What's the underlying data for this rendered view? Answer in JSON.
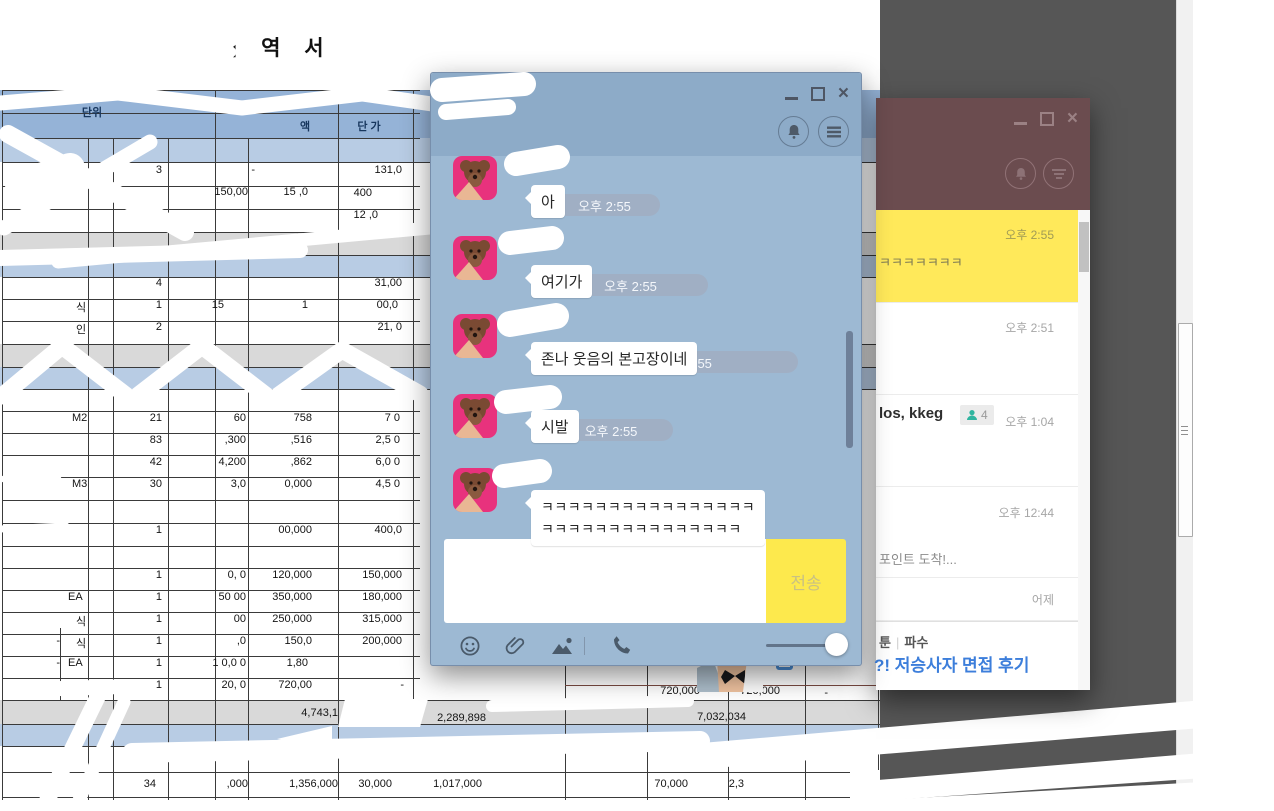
{
  "colors": {
    "chat_header": "#8dabc8",
    "chat_body": "#9db9d3",
    "time_pill": "#a0afc4",
    "send_button_yellow": "#fde94d",
    "friends_header_maroon": "#6b4c4f",
    "selected_chat_yellow": "#ffe95a",
    "ad_link_blue": "#3c7edb",
    "excel_header_blue": "#95b3d7",
    "excel_light_blue_row": "#b8cce4",
    "excel_gray_row": "#d9d9d9",
    "desktop_dark_panel": "#565656",
    "avatar_pink": "#e8327d"
  },
  "spreadsheet": {
    "title": "내 역 서",
    "cells": [
      {
        "x": 70,
        "y": 104,
        "w": 44,
        "t": "단위",
        "a": "c",
        "h": 1
      },
      {
        "x": 382,
        "y": 93,
        "w": 50,
        "t": "노 무",
        "a": "c",
        "h": 1
      },
      {
        "x": 292,
        "y": 118,
        "w": 26,
        "t": "액",
        "a": "c",
        "h": 1
      },
      {
        "x": 344,
        "y": 118,
        "w": 50,
        "t": "단 가",
        "a": "c",
        "h": 1
      },
      {
        "x": 118,
        "y": 164,
        "w": 44,
        "t": "3"
      },
      {
        "x": 225,
        "y": 164,
        "w": 30,
        "t": "-"
      },
      {
        "x": 348,
        "y": 164,
        "w": 54,
        "t": "131,0"
      },
      {
        "x": 192,
        "y": 186,
        "w": 56,
        "t": "150,00"
      },
      {
        "x": 258,
        "y": 186,
        "w": 50,
        "t": "15 ,0"
      },
      {
        "x": 330,
        "y": 187,
        "w": 42,
        "t": "400"
      },
      {
        "x": 328,
        "y": 209,
        "w": 50,
        "t": "12 ,0"
      },
      {
        "x": 276,
        "y": 232,
        "w": 52,
        "t": "150,00"
      },
      {
        "x": 118,
        "y": 277,
        "w": 44,
        "t": "4"
      },
      {
        "x": 352,
        "y": 277,
        "w": 50,
        "t": "31,00"
      },
      {
        "x": 76,
        "y": 299,
        "w": 18,
        "t": "식",
        "a": "l"
      },
      {
        "x": 118,
        "y": 299,
        "w": 44,
        "t": "1"
      },
      {
        "x": 178,
        "y": 299,
        "w": 46,
        "t": "15"
      },
      {
        "x": 270,
        "y": 299,
        "w": 38,
        "t": "1"
      },
      {
        "x": 348,
        "y": 299,
        "w": 50,
        "t": "00,0"
      },
      {
        "x": 76,
        "y": 321,
        "w": 18,
        "t": "인",
        "a": "l"
      },
      {
        "x": 118,
        "y": 321,
        "w": 44,
        "t": "2"
      },
      {
        "x": 350,
        "y": 321,
        "w": 52,
        "t": "21, 0"
      },
      {
        "x": 72,
        "y": 412,
        "w": 26,
        "t": "M2",
        "a": "l"
      },
      {
        "x": 118,
        "y": 412,
        "w": 44,
        "t": "21"
      },
      {
        "x": 192,
        "y": 412,
        "w": 54,
        "t": "60"
      },
      {
        "x": 258,
        "y": 412,
        "w": 54,
        "t": "758"
      },
      {
        "x": 348,
        "y": 412,
        "w": 52,
        "t": "7 0"
      },
      {
        "x": 118,
        "y": 434,
        "w": 44,
        "t": "83"
      },
      {
        "x": 192,
        "y": 434,
        "w": 54,
        "t": ",300"
      },
      {
        "x": 258,
        "y": 434,
        "w": 54,
        "t": ",516"
      },
      {
        "x": 348,
        "y": 434,
        "w": 52,
        "t": "2,5 0"
      },
      {
        "x": 118,
        "y": 456,
        "w": 44,
        "t": "42"
      },
      {
        "x": 192,
        "y": 456,
        "w": 54,
        "t": "4,200"
      },
      {
        "x": 258,
        "y": 456,
        "w": 54,
        "t": ",862"
      },
      {
        "x": 348,
        "y": 456,
        "w": 52,
        "t": "6,0 0"
      },
      {
        "x": 72,
        "y": 478,
        "w": 26,
        "t": "M3",
        "a": "l"
      },
      {
        "x": 118,
        "y": 478,
        "w": 44,
        "t": "30"
      },
      {
        "x": 192,
        "y": 478,
        "w": 54,
        "t": "3,0"
      },
      {
        "x": 258,
        "y": 478,
        "w": 54,
        "t": "0,000"
      },
      {
        "x": 348,
        "y": 478,
        "w": 52,
        "t": "4,5 0"
      },
      {
        "x": 118,
        "y": 524,
        "w": 44,
        "t": "1"
      },
      {
        "x": 256,
        "y": 524,
        "w": 56,
        "t": "00,000"
      },
      {
        "x": 346,
        "y": 524,
        "w": 56,
        "t": "400,0"
      },
      {
        "x": 118,
        "y": 569,
        "w": 44,
        "t": "1"
      },
      {
        "x": 192,
        "y": 569,
        "w": 54,
        "t": "0, 0"
      },
      {
        "x": 256,
        "y": 569,
        "w": 56,
        "t": "120,000"
      },
      {
        "x": 346,
        "y": 569,
        "w": 56,
        "t": "150,000"
      },
      {
        "x": 68,
        "y": 591,
        "w": 26,
        "t": "EA",
        "a": "l"
      },
      {
        "x": 118,
        "y": 591,
        "w": 44,
        "t": "1"
      },
      {
        "x": 192,
        "y": 591,
        "w": 54,
        "t": "50 00"
      },
      {
        "x": 256,
        "y": 591,
        "w": 56,
        "t": "350,000"
      },
      {
        "x": 346,
        "y": 591,
        "w": 56,
        "t": "180,000"
      },
      {
        "x": 76,
        "y": 613,
        "w": 18,
        "t": "식",
        "a": "l"
      },
      {
        "x": 118,
        "y": 613,
        "w": 44,
        "t": "1"
      },
      {
        "x": 192,
        "y": 613,
        "w": 54,
        "t": "00"
      },
      {
        "x": 256,
        "y": 613,
        "w": 56,
        "t": "250,000"
      },
      {
        "x": 346,
        "y": 613,
        "w": 56,
        "t": "315,000"
      },
      {
        "x": 48,
        "y": 635,
        "w": 12,
        "t": "-"
      },
      {
        "x": 76,
        "y": 635,
        "w": 18,
        "t": "식",
        "a": "l"
      },
      {
        "x": 118,
        "y": 635,
        "w": 44,
        "t": "1"
      },
      {
        "x": 192,
        "y": 635,
        "w": 54,
        "t": ",0"
      },
      {
        "x": 256,
        "y": 635,
        "w": 56,
        "t": "150,0"
      },
      {
        "x": 346,
        "y": 635,
        "w": 56,
        "t": "200,000"
      },
      {
        "x": 48,
        "y": 657,
        "w": 12,
        "t": "-"
      },
      {
        "x": 68,
        "y": 657,
        "w": 26,
        "t": "EA",
        "a": "l"
      },
      {
        "x": 118,
        "y": 657,
        "w": 44,
        "t": "1"
      },
      {
        "x": 182,
        "y": 657,
        "w": 64,
        "t": "1 0,0 0"
      },
      {
        "x": 256,
        "y": 657,
        "w": 52,
        "t": "1,80"
      },
      {
        "x": 48,
        "y": 679,
        "w": 12,
        "t": "-"
      },
      {
        "x": 76,
        "y": 679,
        "w": 18,
        "t": "식",
        "a": "l"
      },
      {
        "x": 118,
        "y": 679,
        "w": 44,
        "t": "1"
      },
      {
        "x": 192,
        "y": 679,
        "w": 54,
        "t": "20, 0"
      },
      {
        "x": 256,
        "y": 679,
        "w": 56,
        "t": "720,00"
      },
      {
        "x": 380,
        "y": 679,
        "w": 24,
        "t": "-"
      },
      {
        "x": 642,
        "y": 685,
        "w": 58,
        "t": "720,000"
      },
      {
        "x": 722,
        "y": 685,
        "w": 58,
        "t": "720,000"
      },
      {
        "x": 808,
        "y": 687,
        "w": 20,
        "t": "-"
      },
      {
        "x": 278,
        "y": 707,
        "w": 60,
        "t": "4,743,1"
      },
      {
        "x": 426,
        "y": 712,
        "w": 60,
        "t": "2,289,898"
      },
      {
        "x": 686,
        "y": 711,
        "w": 60,
        "t": "7,032,034"
      },
      {
        "x": 112,
        "y": 778,
        "w": 44,
        "t": "34"
      },
      {
        "x": 196,
        "y": 778,
        "w": 52,
        "t": ",000"
      },
      {
        "x": 278,
        "y": 778,
        "w": 60,
        "t": "1,356,000"
      },
      {
        "x": 350,
        "y": 778,
        "w": 42,
        "t": "30,000"
      },
      {
        "x": 422,
        "y": 778,
        "w": 60,
        "t": "1,017,000"
      },
      {
        "x": 644,
        "y": 778,
        "w": 44,
        "t": "70,000"
      },
      {
        "x": 714,
        "y": 778,
        "w": 30,
        "t": "2,3"
      }
    ]
  },
  "chat_window": {
    "messages": [
      {
        "text": "아",
        "time": "오후 2:55"
      },
      {
        "text": "여기가",
        "time": "오후 2:55"
      },
      {
        "text": "존나 웃음의 본고장이네",
        "time": "오후 2:55"
      },
      {
        "text": "시발",
        "time": "오후 2:55"
      },
      {
        "lines": [
          "ㅋㅋㅋㅋㅋㅋㅋㅋㅋㅋㅋㅋㅋㅋㅋㅋ",
          "ㅋㅋㅋㅋㅋㅋㅋㅋㅋㅋㅋㅋㅋㅋㅋ"
        ]
      }
    ],
    "input_placeholder": "",
    "send_label": "전송"
  },
  "friends_window": {
    "items": [
      {
        "time": "오후 2:55",
        "preview": "ㅋㅋㅋㅋㅋㅋㅋ",
        "selected": true
      },
      {
        "time": "오후 2:51"
      },
      {
        "name": "los, kkeg",
        "member_count": "4",
        "time": "오후 1:04"
      },
      {
        "time": "오후 12:44",
        "preview": "포인트 도착!..."
      },
      {
        "time": "어제"
      }
    ],
    "ad": {
      "category_left": "툰",
      "category_right": "파수",
      "headline": "?! 저승사자 면접 후기"
    }
  }
}
